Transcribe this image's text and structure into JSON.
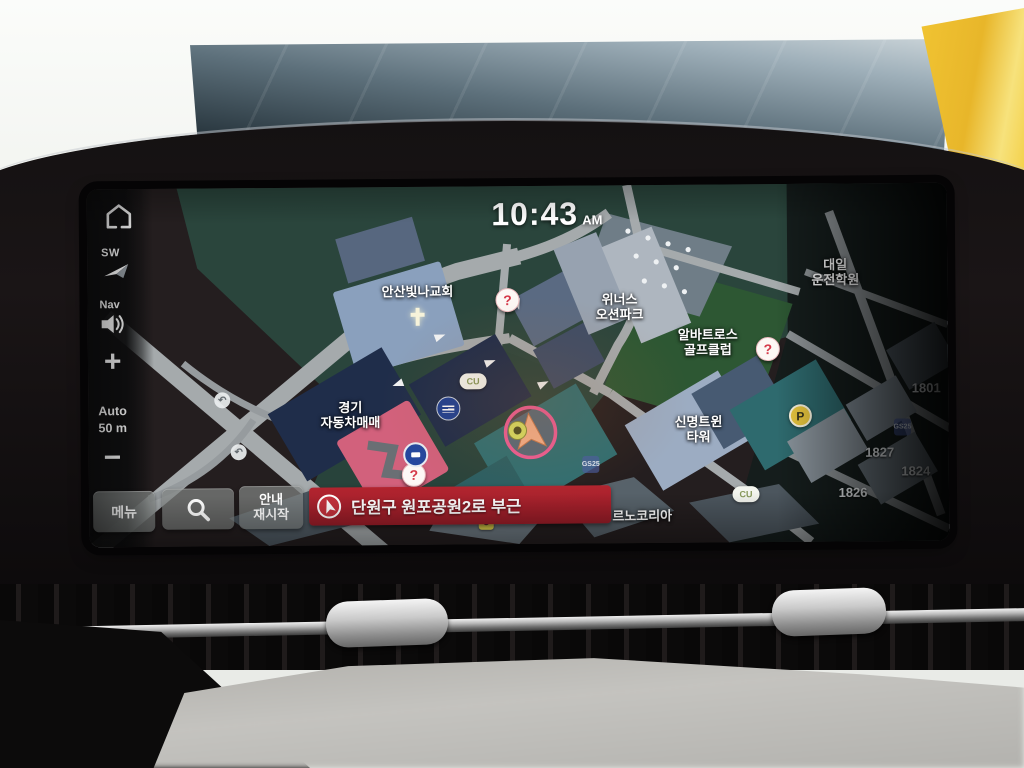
{
  "clock": {
    "time": "10:43",
    "meridiem": "AM"
  },
  "sidebar": {
    "compass_label": "SW",
    "nav_label": "Nav",
    "zoom_in": "+",
    "zoom_out": "−",
    "scale_line1": "Auto",
    "scale_line2": "50 m"
  },
  "toolbar": {
    "menu": "메뉴",
    "resume_line1": "안내",
    "resume_line2": "재시작"
  },
  "banner": {
    "destination": "단원구 원포공원2로 부근"
  },
  "map": {
    "labels": {
      "church": "안산빛나교회",
      "winners_line1": "위너스",
      "winners_line2": "오션파크",
      "albatross_line1": "알바트로스",
      "albatross_line2": "골프클럽",
      "daeil_line1": "대일",
      "daeil_line2": "운전학원",
      "gyeonggi_line1": "경기",
      "gyeonggi_line2": "자동차매매",
      "sinmyeong_line1": "신명트윈",
      "sinmyeong_line2": "타워",
      "renault": "르노코리아"
    },
    "numbers": {
      "n1": "1801",
      "n2": "1827",
      "n3": "1824",
      "n4": "1826"
    },
    "poi": {
      "cu": "CU",
      "gs": "GS25",
      "parking": "P",
      "question": "?",
      "uturn": "↶"
    }
  },
  "colors": {
    "banner_red": "#a8212c",
    "accent_pink": "#ef5d95",
    "map_teal": "#2a453c"
  }
}
